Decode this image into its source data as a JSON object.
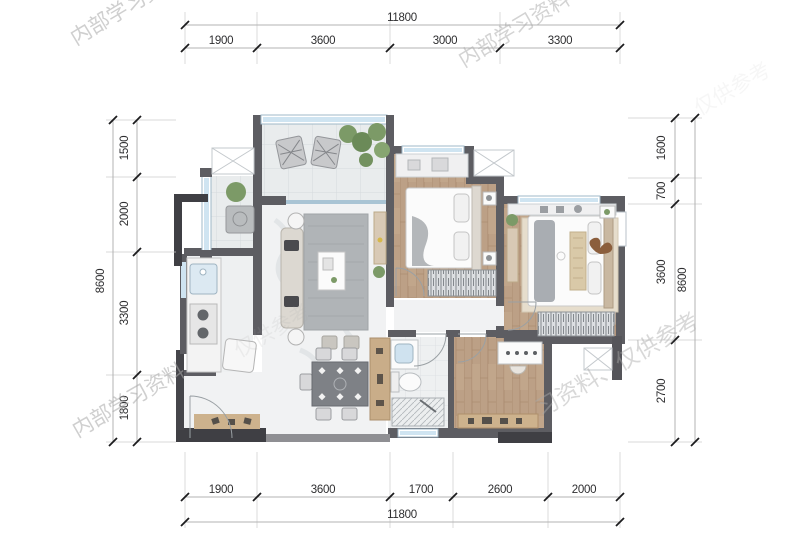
{
  "dimensions": {
    "top": {
      "total": "11800",
      "segments": [
        "1900",
        "3600",
        "3000",
        "3300"
      ]
    },
    "bottom": {
      "total": "11800",
      "segments": [
        "1900",
        "3600",
        "1700",
        "2600",
        "2000"
      ]
    },
    "left": {
      "total": "8600",
      "segments": [
        "1500",
        "2000",
        "3300",
        "1800"
      ]
    },
    "right": {
      "total": "8600",
      "segments": [
        "1600",
        "700",
        "3600",
        "2700"
      ]
    }
  },
  "watermarks": [
    {
      "text": "内部学习资料"
    },
    {
      "text": "内部学习资料"
    },
    {
      "text": "仅供参考"
    },
    {
      "text": "仅供参考"
    },
    {
      "text": "内部学习资料"
    },
    {
      "text": "习资料、仅供参考"
    }
  ],
  "colors": {
    "wall": "#5d5d62",
    "wall_dark": "#3f3f44",
    "window_blue": "#cfe4f1",
    "wood_floor": "#bca086",
    "tile_floor": "#e9eced",
    "marble_floor": "#f1f2f3",
    "dimension_text": "#2e2e30",
    "watermark_gray": "#a9a9a9"
  }
}
